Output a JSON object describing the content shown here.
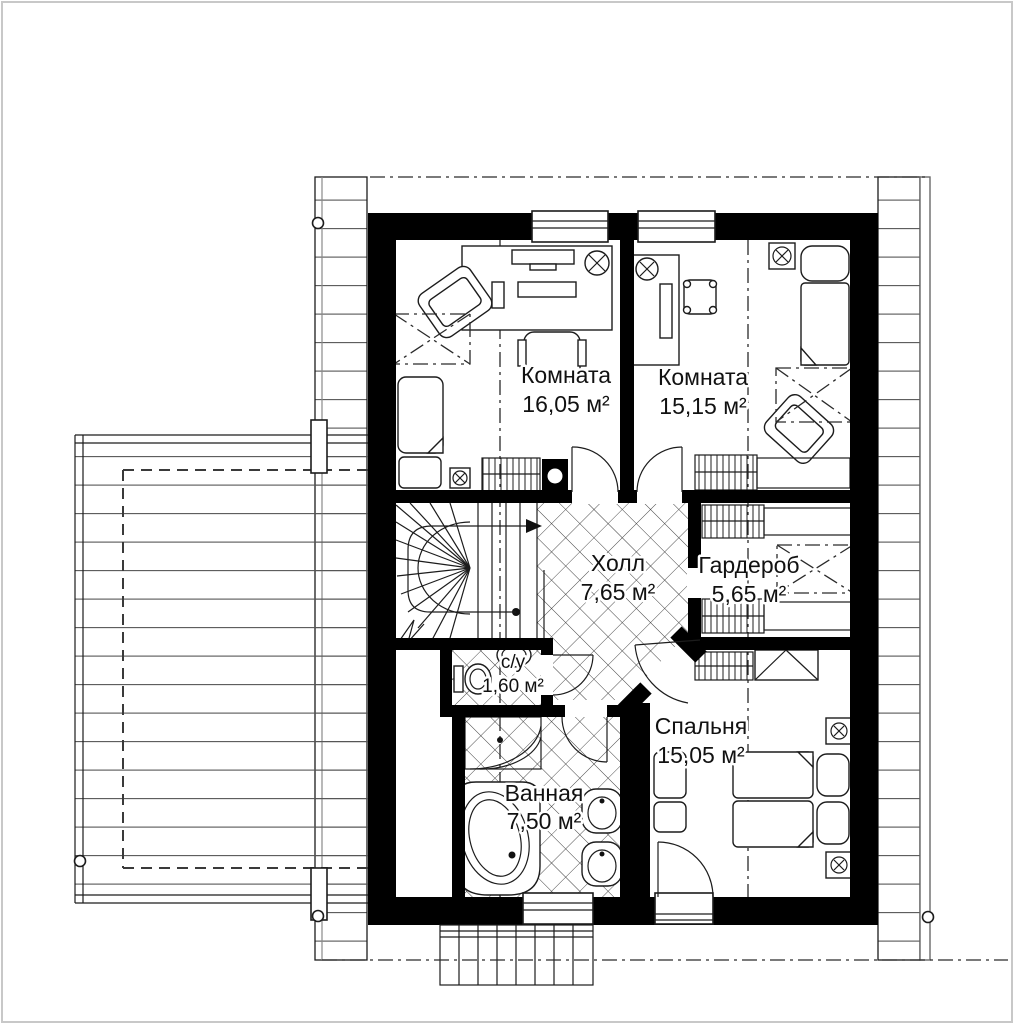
{
  "plan": {
    "type": "floor-plan",
    "rooms": [
      {
        "id": "room-1",
        "name": "Комната",
        "area": "16,05 м²"
      },
      {
        "id": "room-2",
        "name": "Комната",
        "area": "15,15 м²"
      },
      {
        "id": "hall",
        "name": "Холл",
        "area": "7,65 м²"
      },
      {
        "id": "wardrobe",
        "name": "Гардероб",
        "area": "5,65 м²"
      },
      {
        "id": "wc",
        "name": "с/у",
        "area": "1,60 м²"
      },
      {
        "id": "bedroom",
        "name": "Спальня",
        "area": "15,05 м²"
      },
      {
        "id": "bathroom",
        "name": "Ванная",
        "area": "7,50 м²"
      }
    ],
    "colors": {
      "wall": "#000000",
      "background": "#ffffff",
      "line": "#1c1c1c",
      "page_border": "#c8c8c8"
    }
  }
}
